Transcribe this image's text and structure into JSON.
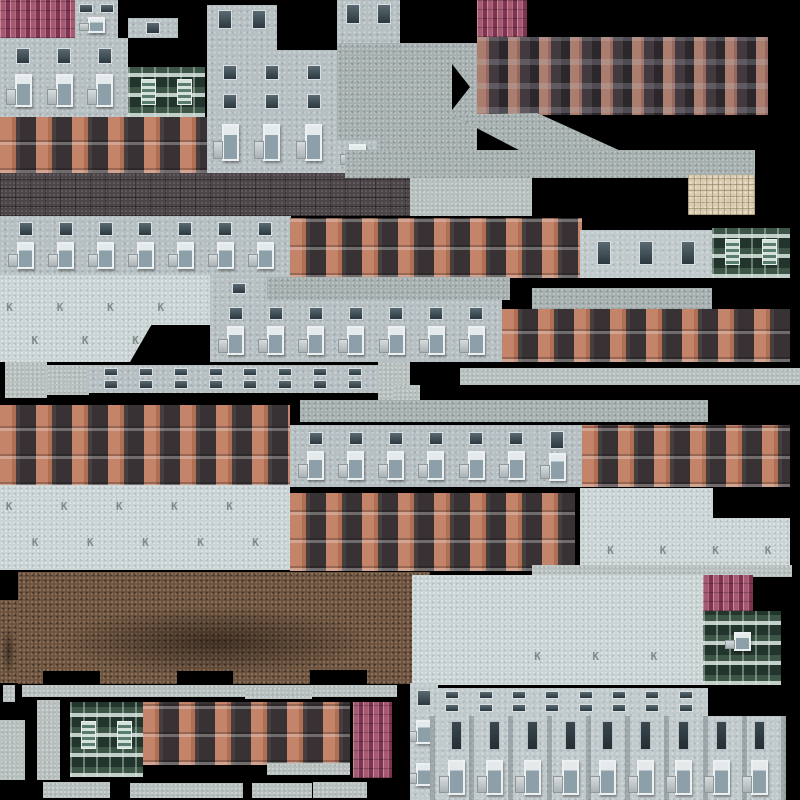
{
  "canvas": {
    "w": 800,
    "h": 800,
    "background": "#000000"
  },
  "k_glyph": "K",
  "palette": {
    "background": "#000000",
    "roof_pink": "#9c4c63",
    "brick_dark_bay": "#342e32",
    "brick_pillar_pink": "#aa7d6f",
    "brick_pillar_orange": "#c4846a",
    "concrete_facade": "#b6bfc2",
    "concrete_pale": "#c9d3d4",
    "concrete_roof_slab": "#a6afaf",
    "trim_light": "#b9c1c0",
    "stone_beige": "#d8cbae",
    "ground_brick_brown": "#6b523f",
    "wall_dark_brick": "#4c4649",
    "green_facade": "#31463c"
  },
  "patches": [
    {
      "name": "roof-ridged-a",
      "tex": "roofp",
      "x": 0,
      "y": 0,
      "w": 76,
      "h": 38
    },
    {
      "name": "facade-col-a",
      "tex": "cfac",
      "x": 75,
      "y": 0,
      "w": 43,
      "h": 38,
      "rows": [
        {
          "t": 10,
          "h": 24,
          "n": 2,
          "s": "d"
        },
        {
          "t": 45,
          "h": 42,
          "n": 1,
          "s": "w"
        }
      ]
    },
    {
      "name": "facade-small-a",
      "tex": "cfac",
      "x": 128,
      "y": 18,
      "w": 50,
      "h": 20,
      "rows": [
        {
          "t": 22,
          "h": 56,
          "n": 1,
          "s": "d"
        }
      ]
    },
    {
      "name": "facade-block-a",
      "tex": "cfac",
      "x": 0,
      "y": 38,
      "w": 128,
      "h": 79,
      "rows": [
        {
          "t": 13,
          "h": 20,
          "n": 3,
          "s": "d"
        },
        {
          "t": 45,
          "h": 42,
          "n": 3,
          "s": "w"
        }
      ]
    },
    {
      "name": "green-facade-a",
      "tex": "green",
      "x": 128,
      "y": 67,
      "w": 77,
      "h": 50,
      "rows": [
        {
          "t": 24,
          "h": 52,
          "n": 2,
          "s": "t"
        }
      ]
    },
    {
      "name": "brick-row-a",
      "tex": "bred",
      "x": 0,
      "y": 117,
      "w": 207,
      "h": 56
    },
    {
      "name": "facade-tower-top",
      "tex": "cfac",
      "x": 207,
      "y": 5,
      "w": 70,
      "h": 45,
      "rows": [
        {
          "t": 10,
          "h": 44,
          "n": 2,
          "s": "d"
        }
      ]
    },
    {
      "name": "facade-tower",
      "tex": "cfac",
      "x": 207,
      "y": 50,
      "w": 130,
      "h": 123,
      "rows": [
        {
          "t": 12,
          "h": 12,
          "n": 3,
          "s": "d"
        },
        {
          "t": 36,
          "h": 12,
          "n": 3,
          "s": "d"
        },
        {
          "t": 60,
          "h": 30,
          "n": 3,
          "s": "w"
        }
      ]
    },
    {
      "name": "facade-col-b-top",
      "tex": "cfac",
      "x": 337,
      "y": 0,
      "w": 63,
      "h": 43,
      "rows": [
        {
          "t": 10,
          "h": 46,
          "n": 2,
          "s": "d"
        }
      ]
    },
    {
      "name": "roof-slab-a",
      "tex": "croof",
      "x": 337,
      "y": 43,
      "w": 140,
      "h": 130
    },
    {
      "name": "facade-window-piece",
      "tex": "cfac",
      "x": 337,
      "y": 140,
      "w": 40,
      "h": 33,
      "rows": [
        {
          "t": 12,
          "h": 70,
          "n": 1,
          "s": "w"
        }
      ]
    },
    {
      "name": "chevron-notch",
      "tex": "black",
      "x": 452,
      "y": 64,
      "w": 18,
      "h": 46,
      "clip": "polygon(0 0,100% 50%,0 100%)"
    },
    {
      "name": "roof-ridged-b",
      "tex": "roofp",
      "x": 477,
      "y": 0,
      "w": 50,
      "h": 37
    },
    {
      "name": "brick-terrace-a",
      "tex": "bdark",
      "x": 477,
      "y": 37,
      "w": 291,
      "h": 78
    },
    {
      "name": "roof-slab-slant",
      "tex": "croof",
      "x": 440,
      "y": 113,
      "w": 180,
      "h": 40,
      "clip": "polygon(6% 4%,54% 0,100% 94%,47% 100%)"
    },
    {
      "name": "brick-wall-dark",
      "tex": "wallb",
      "x": 0,
      "y": 173,
      "w": 410,
      "h": 43
    },
    {
      "name": "roof-slab-strip",
      "tex": "croof",
      "x": 345,
      "y": 150,
      "w": 410,
      "h": 28
    },
    {
      "name": "trim-slab-a",
      "tex": "trim",
      "x": 410,
      "y": 178,
      "w": 122,
      "h": 38
    },
    {
      "name": "stone-tiles",
      "tex": "stone",
      "x": 688,
      "y": 175,
      "w": 67,
      "h": 40
    },
    {
      "name": "facade-row-a",
      "tex": "cfac",
      "x": 0,
      "y": 216,
      "w": 291,
      "h": 62,
      "rows": [
        {
          "t": 10,
          "h": 22,
          "n": 7,
          "s": "d"
        },
        {
          "t": 42,
          "h": 44,
          "n": 7,
          "s": "w"
        }
      ]
    },
    {
      "name": "brick-row-b",
      "tex": "bred",
      "x": 290,
      "y": 218,
      "w": 292,
      "h": 60
    },
    {
      "name": "facade-3win",
      "tex": "cfac2",
      "x": 580,
      "y": 230,
      "w": 132,
      "h": 48,
      "rows": [
        {
          "t": 22,
          "h": 50,
          "n": 3,
          "s": "d"
        }
      ]
    },
    {
      "name": "green-facade-b",
      "tex": "green",
      "x": 712,
      "y": 228,
      "w": 78,
      "h": 50,
      "rows": [
        {
          "t": 22,
          "h": 52,
          "n": 2,
          "s": "t"
        }
      ]
    },
    {
      "name": "concrete-pale-a",
      "tex": "cplain",
      "x": 0,
      "y": 275,
      "w": 210,
      "h": 87,
      "k": [
        [
          3,
          30
        ],
        [
          27,
          30
        ],
        [
          51,
          30
        ],
        [
          75,
          30
        ],
        [
          15,
          68
        ],
        [
          39,
          68
        ],
        [
          63,
          68
        ],
        [
          87,
          68
        ]
      ]
    },
    {
      "name": "notch-trapezoid",
      "tex": "black",
      "x": 130,
      "y": 325,
      "w": 82,
      "h": 37,
      "clip": "polygon(26% 0,100% 0,100% 100%,0 100%)"
    },
    {
      "name": "facade-row-b-upper",
      "tex": "cfac",
      "x": 210,
      "y": 277,
      "w": 57,
      "h": 23,
      "rows": [
        {
          "t": 25,
          "h": 50,
          "n": 1,
          "s": "d"
        }
      ]
    },
    {
      "name": "roof-strip-a",
      "tex": "croof",
      "x": 267,
      "y": 277,
      "w": 243,
      "h": 23
    },
    {
      "name": "facade-row-b",
      "tex": "cfac",
      "x": 210,
      "y": 300,
      "w": 292,
      "h": 62,
      "rows": [
        {
          "t": 12,
          "h": 20,
          "n": 7,
          "s": "d"
        },
        {
          "t": 42,
          "h": 46,
          "n": 7,
          "s": "w"
        }
      ]
    },
    {
      "name": "roof-strip-b",
      "tex": "croof",
      "x": 532,
      "y": 288,
      "w": 180,
      "h": 21
    },
    {
      "name": "brick-row-c",
      "tex": "bred",
      "x": 502,
      "y": 309,
      "w": 288,
      "h": 53
    },
    {
      "name": "trim-strip-a",
      "tex": "trim",
      "x": 460,
      "y": 368,
      "w": 340,
      "h": 17
    },
    {
      "name": "trim-block-a",
      "tex": "trim",
      "x": 5,
      "y": 362,
      "w": 42,
      "h": 36
    },
    {
      "name": "trim-block-b",
      "tex": "trim",
      "x": 47,
      "y": 365,
      "w": 42,
      "h": 30
    },
    {
      "name": "window-strip-a",
      "tex": "cfac",
      "x": 88,
      "y": 365,
      "w": 290,
      "h": 28,
      "rows": [
        {
          "t": 10,
          "h": 30,
          "n": 8,
          "s": "d"
        },
        {
          "t": 55,
          "h": 30,
          "n": 8,
          "s": "d"
        }
      ]
    },
    {
      "name": "trim-block-c",
      "tex": "trim",
      "x": 378,
      "y": 362,
      "w": 32,
      "h": 38
    },
    {
      "name": "trim-tab-a",
      "tex": "trim",
      "x": 393,
      "y": 385,
      "w": 27,
      "h": 17
    },
    {
      "name": "brick-block-a",
      "tex": "bred",
      "x": 0,
      "y": 405,
      "w": 290,
      "h": 82
    },
    {
      "name": "roof-strip-c",
      "tex": "croof",
      "x": 300,
      "y": 400,
      "w": 408,
      "h": 22
    },
    {
      "name": "facade-row-c",
      "tex": "cfac",
      "x": 290,
      "y": 425,
      "w": 292,
      "h": 62,
      "rows": [
        {
          "t": 12,
          "h": 20,
          "n": 7,
          "s": "d"
        },
        {
          "t": 42,
          "h": 46,
          "n": 7,
          "s": "w"
        }
      ]
    },
    {
      "name": "facade-piece-a",
      "tex": "cfac",
      "x": 532,
      "y": 425,
      "w": 50,
      "h": 62,
      "rows": [
        {
          "t": 10,
          "h": 28,
          "n": 1,
          "s": "d"
        },
        {
          "t": 45,
          "h": 45,
          "n": 1,
          "s": "w"
        }
      ]
    },
    {
      "name": "brick-row-d",
      "tex": "bred",
      "x": 582,
      "y": 425,
      "w": 208,
      "h": 62
    },
    {
      "name": "concrete-pale-b",
      "tex": "cplain",
      "x": 0,
      "y": 485,
      "w": 290,
      "h": 85,
      "k": [
        [
          2,
          18
        ],
        [
          21,
          18
        ],
        [
          40,
          18
        ],
        [
          59,
          18
        ],
        [
          78,
          18
        ],
        [
          11,
          60
        ],
        [
          30,
          60
        ],
        [
          49,
          60
        ],
        [
          68,
          60
        ],
        [
          87,
          60
        ]
      ]
    },
    {
      "name": "brick-block-b",
      "tex": "bred",
      "x": 290,
      "y": 493,
      "w": 285,
      "h": 78
    },
    {
      "name": "concrete-pale-c",
      "tex": "cplain",
      "x": 580,
      "y": 488,
      "w": 133,
      "h": 30
    },
    {
      "name": "concrete-pale-d",
      "tex": "cplain",
      "x": 580,
      "y": 518,
      "w": 210,
      "h": 57,
      "k": [
        [
          13,
          45
        ],
        [
          38,
          45
        ],
        [
          63,
          45
        ],
        [
          88,
          45
        ]
      ]
    },
    {
      "name": "ground-bricks",
      "tex": "ground",
      "x": 18,
      "y": 572,
      "w": 412,
      "h": 112
    },
    {
      "name": "ground-bricks-edge",
      "tex": "ground",
      "x": 0,
      "y": 600,
      "w": 18,
      "h": 83
    },
    {
      "name": "ground-notch-a",
      "tex": "black",
      "x": 43,
      "y": 671,
      "w": 57,
      "h": 13
    },
    {
      "name": "ground-notch-b",
      "tex": "black",
      "x": 177,
      "y": 671,
      "w": 56,
      "h": 13
    },
    {
      "name": "ground-notch-c",
      "tex": "black",
      "x": 310,
      "y": 670,
      "w": 57,
      "h": 14
    },
    {
      "name": "trim-strip-b",
      "tex": "trim",
      "x": 532,
      "y": 565,
      "w": 260,
      "h": 12
    },
    {
      "name": "concrete-pale-e",
      "tex": "cplain",
      "x": 412,
      "y": 575,
      "w": 291,
      "h": 110,
      "k": [
        [
          42,
          68
        ],
        [
          62,
          68
        ],
        [
          82,
          68
        ]
      ]
    },
    {
      "name": "roof-ridged-c",
      "tex": "roofp",
      "x": 703,
      "y": 575,
      "w": 50,
      "h": 36
    },
    {
      "name": "green-balcony",
      "tex": "green",
      "x": 703,
      "y": 611,
      "w": 78,
      "h": 74,
      "rows": [
        {
          "t": 28,
          "h": 26,
          "n": 1,
          "s": "w"
        }
      ]
    },
    {
      "name": "trim-top-strip",
      "tex": "trim",
      "x": 22,
      "y": 685,
      "w": 375,
      "h": 12
    },
    {
      "name": "trim-block-d",
      "tex": "trim",
      "x": 3,
      "y": 685,
      "w": 12,
      "h": 17
    },
    {
      "name": "trim-col-a",
      "tex": "trim",
      "x": 0,
      "y": 720,
      "w": 25,
      "h": 60
    },
    {
      "name": "trim-col-b",
      "tex": "trim",
      "x": 37,
      "y": 700,
      "w": 23,
      "h": 80
    },
    {
      "name": "green-facade-c",
      "tex": "green",
      "x": 70,
      "y": 702,
      "w": 73,
      "h": 75,
      "rows": [
        {
          "t": 25,
          "h": 38,
          "n": 2,
          "s": "t"
        }
      ]
    },
    {
      "name": "brick-row-e",
      "tex": "bred",
      "x": 143,
      "y": 702,
      "w": 207,
      "h": 63
    },
    {
      "name": "trim-strip-c",
      "tex": "trim",
      "x": 245,
      "y": 687,
      "w": 67,
      "h": 12
    },
    {
      "name": "trim-strip-d",
      "tex": "trim",
      "x": 267,
      "y": 763,
      "w": 83,
      "h": 12
    },
    {
      "name": "roof-ridged-d",
      "tex": "roofp",
      "x": 353,
      "y": 702,
      "w": 39,
      "h": 76
    },
    {
      "name": "trim-bottom-a",
      "tex": "trim",
      "x": 43,
      "y": 782,
      "w": 67,
      "h": 16
    },
    {
      "name": "trim-bottom-b",
      "tex": "trim",
      "x": 130,
      "y": 783,
      "w": 113,
      "h": 15
    },
    {
      "name": "trim-bottom-c",
      "tex": "trim",
      "x": 252,
      "y": 783,
      "w": 60,
      "h": 15
    },
    {
      "name": "trim-bottom-d",
      "tex": "trim",
      "x": 313,
      "y": 782,
      "w": 54,
      "h": 16
    },
    {
      "name": "facade-col-right",
      "tex": "cfac2",
      "x": 410,
      "y": 683,
      "w": 28,
      "h": 117,
      "rows": [
        {
          "t": 6,
          "h": 14,
          "n": 1,
          "s": "d"
        },
        {
          "t": 32,
          "h": 20,
          "n": 1,
          "s": "w"
        },
        {
          "t": 68,
          "h": 20,
          "n": 1,
          "s": "w"
        }
      ]
    },
    {
      "name": "window-strip-b",
      "tex": "cfac2",
      "x": 430,
      "y": 688,
      "w": 278,
      "h": 28,
      "rows": [
        {
          "t": 12,
          "h": 28,
          "n": 8,
          "s": "d"
        },
        {
          "t": 56,
          "h": 28,
          "n": 8,
          "s": "d"
        }
      ]
    },
    {
      "name": "facade-big",
      "tex": "cfac2",
      "x": 430,
      "y": 716,
      "w": 356,
      "h": 84,
      "pilasters": true,
      "rows": [
        {
          "t": 6,
          "h": 34,
          "n": 9,
          "s": "v"
        },
        {
          "t": 52,
          "h": 42,
          "n": 9,
          "s": "w"
        }
      ]
    }
  ]
}
